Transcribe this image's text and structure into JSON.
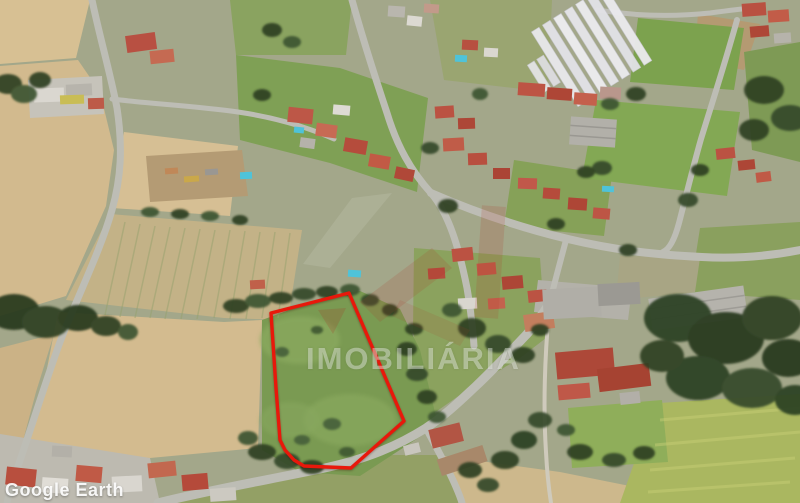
{
  "watermarks": {
    "provider": "Google Earth",
    "agency_text": "IMOBILIÁRIA"
  },
  "overlay": {
    "boundary_points": "349,293 404,421 351,468 304,466 294,460 285,450 280,440 276,388 271,313",
    "boundary_color": "#e8180b"
  },
  "scene": {
    "type": "aerial-satellite-view",
    "description": "Aerial view of a rural village: plowed tan fields on the left, red-roofed houses along roads in the center, greenhouses top right, dense trees lower right, and a green land plot outlined in red in the lower center",
    "palette": {
      "field_tan": "#d2bc92",
      "meadow_green": "#7a9a52",
      "road_gray": "#bdbdb5",
      "roof_red": "#b84f3e",
      "tree_green": "#2e4124",
      "greenhouse_white": "#e9e9ec"
    }
  }
}
